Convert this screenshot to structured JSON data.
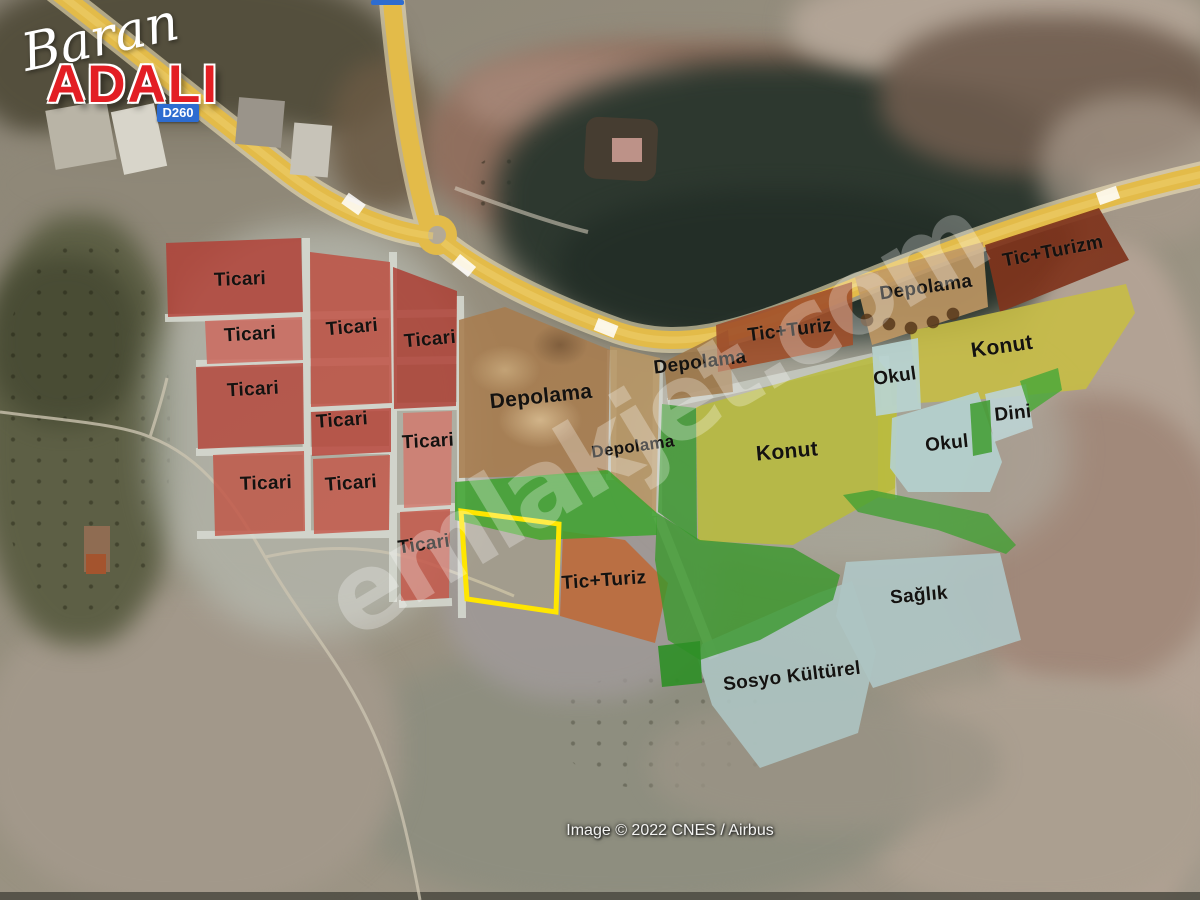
{
  "branding": {
    "name_script": "Baran",
    "name_caps": "ADALI",
    "caps_color": "#e31e24"
  },
  "road_signs": [
    {
      "text": "D260",
      "color": "#2d6cd0"
    }
  ],
  "watermark": {
    "text": "emlakjet.com",
    "opacity": 0.28
  },
  "attribution": {
    "text": "Image © 2022 CNES / Airbus"
  },
  "zone_palette": {
    "ticari_red": "#b94a3e",
    "depolama_brown": "#a87c4e",
    "tic_turiz_orange": "#a04f2a",
    "konut_yellow": "#c2bd45",
    "sosyal_blue": "#b4cdca",
    "green_area": "#3da32f",
    "highway_yellow": "#e3bb49",
    "parcel_outline_yellow": "#ffe600"
  },
  "labels": [
    {
      "text": "Ticari"
    },
    {
      "text": "Ticari"
    },
    {
      "text": "Ticari"
    },
    {
      "text": "Ticari"
    },
    {
      "text": "Ticari"
    },
    {
      "text": "Ticari"
    },
    {
      "text": "Ticari"
    },
    {
      "text": "Ticari"
    },
    {
      "text": "Ticari"
    },
    {
      "text": "Ticari"
    },
    {
      "text": "Depolama"
    },
    {
      "text": "Depolama"
    },
    {
      "text": "Depolama"
    },
    {
      "text": "Depolama"
    },
    {
      "text": "Tic+Turiz"
    },
    {
      "text": "Tic+Turizm"
    },
    {
      "text": "Tic+Turiz"
    },
    {
      "text": "Konut"
    },
    {
      "text": "Konut"
    },
    {
      "text": "Okul"
    },
    {
      "text": "Okul"
    },
    {
      "text": "Dini"
    },
    {
      "text": "Sağlık"
    },
    {
      "text": "Sosyo Kültürel"
    }
  ]
}
